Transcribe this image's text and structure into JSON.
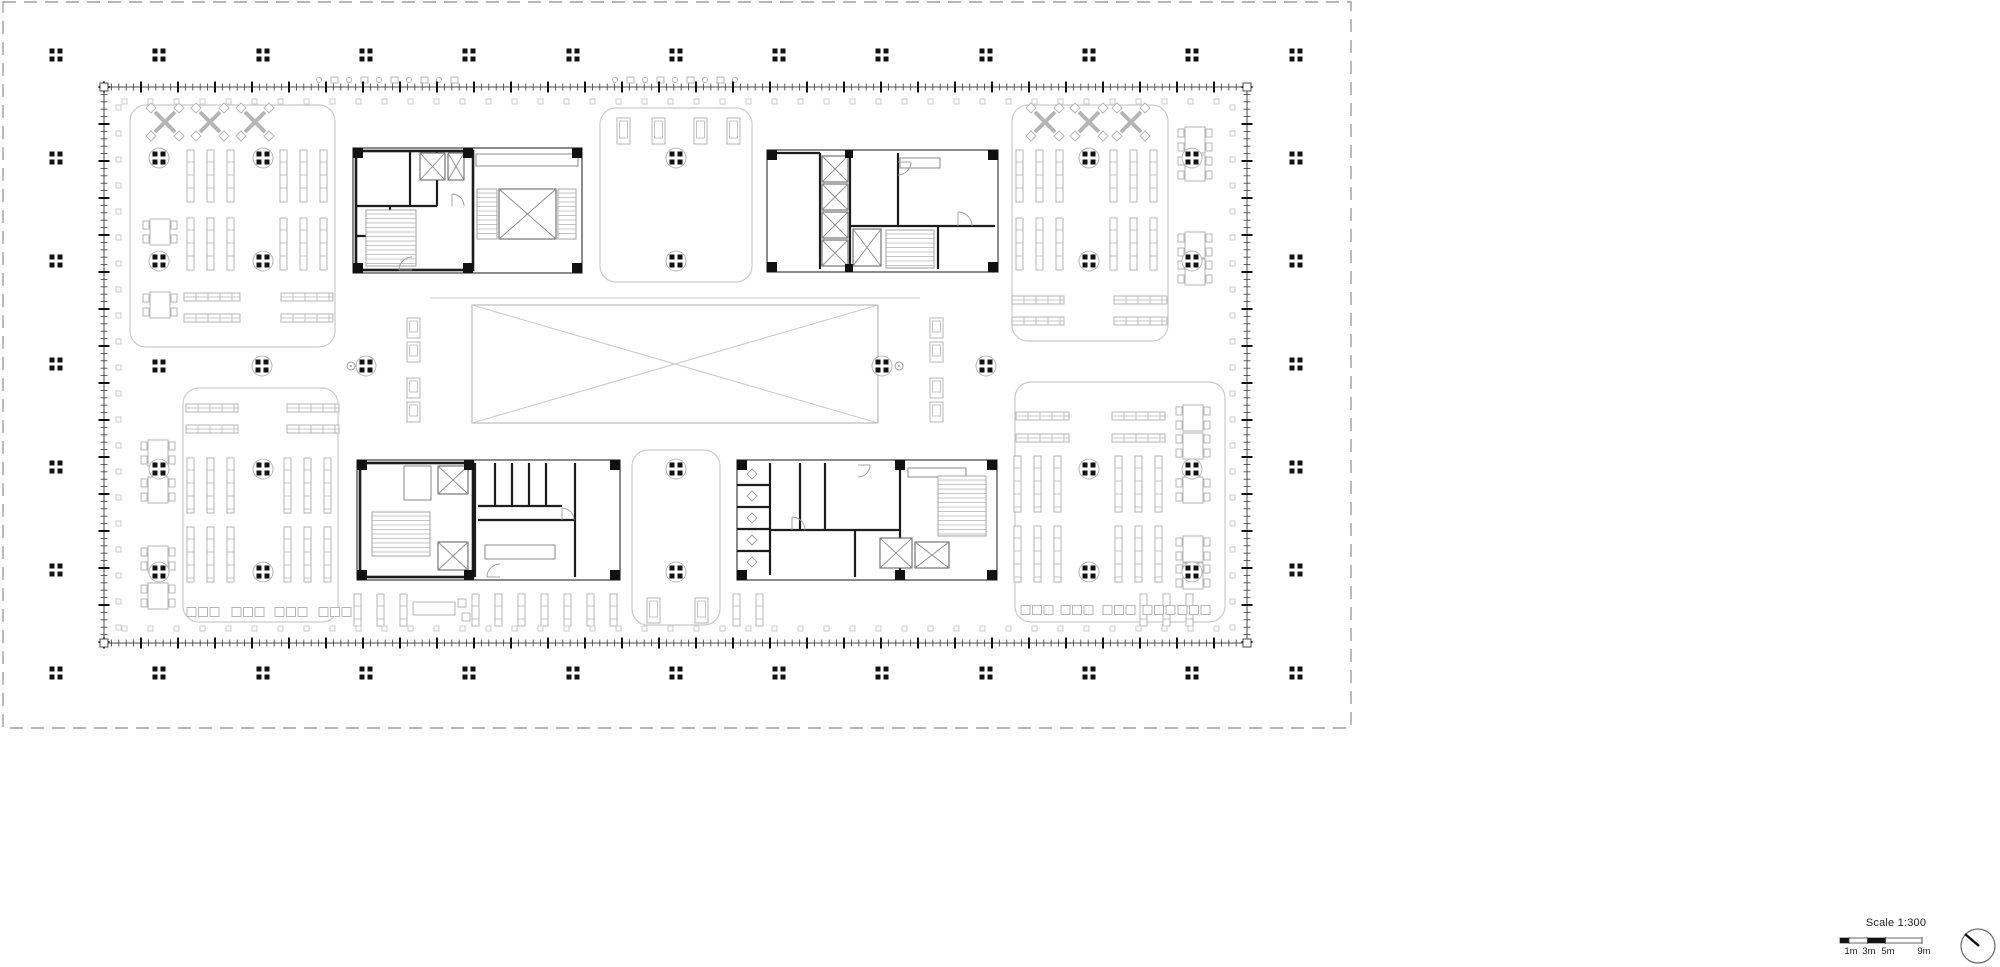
{
  "scale_indicator": {
    "label": "Scale 1:300",
    "tick_labels": [
      "1m",
      "3m",
      "5m",
      "9m"
    ],
    "bar": {
      "total_m": 9,
      "dark_segments_m": [
        [
          0,
          1
        ],
        [
          3,
          5
        ]
      ]
    }
  },
  "colors": {
    "black": "#121212",
    "wall": "#4a4a4a",
    "core": "#1c1c1c",
    "light": "#b5b5b5",
    "zone": "#cbcbcb",
    "boundary": "#9e9e9e",
    "door": "#9a9a9a"
  },
  "drawing": {
    "type": "library floor plan",
    "site_boundary": {
      "x": 3,
      "y": 2,
      "w": 1348,
      "h": 726
    },
    "building": {
      "x": 104,
      "y": 87,
      "w": 1143,
      "h": 556
    },
    "central_void": {
      "x": 472,
      "y": 305,
      "w": 406,
      "h": 118
    },
    "bridge_line": {
      "x1": 430,
      "y1": 298,
      "x2": 920,
      "y2": 298
    },
    "grid": {
      "cols_x": [
        56,
        159,
        263,
        366,
        469,
        573,
        676,
        779,
        882,
        986,
        1089,
        1192,
        1296
      ],
      "rows_y": [
        55,
        158,
        261,
        364,
        467,
        570,
        673
      ],
      "interior_circled": [
        [
          159,
          158
        ],
        [
          263,
          158
        ],
        [
          676,
          158
        ],
        [
          1089,
          158
        ],
        [
          1192,
          158
        ],
        [
          159,
          261
        ],
        [
          263,
          261
        ],
        [
          676,
          261
        ],
        [
          1089,
          261
        ],
        [
          1192,
          261
        ],
        [
          262,
          366
        ],
        [
          366,
          366
        ],
        [
          882,
          366
        ],
        [
          986,
          366
        ],
        [
          159,
          469
        ],
        [
          263,
          469
        ],
        [
          676,
          469
        ],
        [
          1089,
          469
        ],
        [
          1192,
          469
        ],
        [
          159,
          572
        ],
        [
          263,
          572
        ],
        [
          676,
          572
        ],
        [
          1089,
          572
        ],
        [
          1192,
          572
        ]
      ],
      "interior_plain": [
        [
          159,
          366
        ]
      ],
      "survey_marks": [
        [
          351,
          366
        ],
        [
          899,
          366
        ]
      ]
    },
    "zones": [
      {
        "name": "zone-reading-top-left",
        "x": 130,
        "y": 105,
        "w": 205,
        "h": 242
      },
      {
        "name": "zone-reading-top-right",
        "x": 1012,
        "y": 105,
        "w": 156,
        "h": 236
      },
      {
        "name": "zone-reading-bottom-left",
        "x": 183,
        "y": 388,
        "w": 155,
        "h": 234
      },
      {
        "name": "zone-reading-bottom-right",
        "x": 1015,
        "y": 382,
        "w": 210,
        "h": 240
      },
      {
        "name": "zone-lounge-top-middle",
        "x": 600,
        "y": 108,
        "w": 152,
        "h": 174
      },
      {
        "name": "zone-lounge-bottom-middle",
        "x": 632,
        "y": 450,
        "w": 88,
        "h": 175
      }
    ],
    "furniture": {
      "v_shelf_groups": [
        {
          "x": 187,
          "y": 150,
          "h": 52,
          "count": 3,
          "step": 20
        },
        {
          "x": 280,
          "y": 150,
          "h": 52,
          "count": 3,
          "step": 20
        },
        {
          "x": 187,
          "y": 218,
          "h": 52,
          "count": 3,
          "step": 20
        },
        {
          "x": 280,
          "y": 218,
          "h": 52,
          "count": 3,
          "step": 20
        },
        {
          "x": 1016,
          "y": 150,
          "h": 52,
          "count": 3,
          "step": 20
        },
        {
          "x": 1110,
          "y": 150,
          "h": 52,
          "count": 3,
          "step": 20
        },
        {
          "x": 1016,
          "y": 218,
          "h": 52,
          "count": 3,
          "step": 20
        },
        {
          "x": 1110,
          "y": 218,
          "h": 52,
          "count": 3,
          "step": 20
        },
        {
          "x": 187,
          "y": 458,
          "h": 55,
          "count": 3,
          "step": 20
        },
        {
          "x": 284,
          "y": 458,
          "h": 55,
          "count": 3,
          "step": 20
        },
        {
          "x": 187,
          "y": 527,
          "h": 55,
          "count": 3,
          "step": 20
        },
        {
          "x": 284,
          "y": 527,
          "h": 55,
          "count": 3,
          "step": 20
        },
        {
          "x": 1014,
          "y": 456,
          "h": 56,
          "count": 3,
          "step": 20
        },
        {
          "x": 1115,
          "y": 456,
          "h": 56,
          "count": 3,
          "step": 20
        },
        {
          "x": 1014,
          "y": 526,
          "h": 56,
          "count": 3,
          "step": 20
        },
        {
          "x": 1115,
          "y": 526,
          "h": 56,
          "count": 3,
          "step": 20
        },
        {
          "x": 354,
          "y": 594,
          "h": 32,
          "count": 3,
          "step": 23
        },
        {
          "x": 472,
          "y": 594,
          "h": 32,
          "count": 7,
          "step": 23
        },
        {
          "x": 733,
          "y": 594,
          "h": 32,
          "count": 2,
          "step": 23
        },
        {
          "x": 1140,
          "y": 594,
          "h": 32,
          "count": 3,
          "step": 23
        }
      ],
      "h_shelf_groups": [
        {
          "x": 184,
          "y": 293,
          "w": 56
        },
        {
          "x": 184,
          "y": 314,
          "w": 56
        },
        {
          "x": 281,
          "y": 293,
          "w": 52
        },
        {
          "x": 281,
          "y": 314,
          "w": 52
        },
        {
          "x": 1012,
          "y": 296,
          "w": 52
        },
        {
          "x": 1012,
          "y": 317,
          "w": 52
        },
        {
          "x": 1114,
          "y": 296,
          "w": 53
        },
        {
          "x": 1114,
          "y": 317,
          "w": 53
        },
        {
          "x": 186,
          "y": 404,
          "w": 52
        },
        {
          "x": 186,
          "y": 425,
          "w": 52
        },
        {
          "x": 287,
          "y": 404,
          "w": 52
        },
        {
          "x": 287,
          "y": 425,
          "w": 52
        },
        {
          "x": 1016,
          "y": 412,
          "w": 53
        },
        {
          "x": 1016,
          "y": 434,
          "w": 53
        },
        {
          "x": 1112,
          "y": 412,
          "w": 53
        },
        {
          "x": 1112,
          "y": 434,
          "w": 53
        }
      ],
      "x_tables": [
        [
          165,
          122
        ],
        [
          210,
          122
        ],
        [
          255,
          122
        ],
        [
          1045,
          122
        ],
        [
          1089,
          122
        ],
        [
          1131,
          122
        ]
      ],
      "square_tables": [
        [
          158,
          453
        ],
        [
          158,
          490
        ],
        [
          158,
          559
        ],
        [
          158,
          596
        ],
        [
          160,
          232
        ],
        [
          160,
          305
        ],
        [
          1195,
          140
        ],
        [
          1195,
          168
        ],
        [
          1195,
          245
        ],
        [
          1195,
          272
        ],
        [
          1193,
          418
        ],
        [
          1193,
          446
        ],
        [
          1193,
          490
        ],
        [
          1193,
          549
        ],
        [
          1193,
          576
        ]
      ],
      "seat_groups": [
        [
          202,
          612
        ],
        [
          247,
          612
        ],
        [
          290,
          612
        ],
        [
          334,
          612
        ],
        [
          1036,
          610
        ],
        [
          1076,
          610
        ],
        [
          1118,
          610
        ],
        [
          1158,
          610
        ],
        [
          1193,
          610
        ]
      ],
      "lounge_chairs": [
        [
          617,
          118,
          26
        ],
        [
          652,
          118,
          26
        ],
        [
          694,
          118,
          26
        ],
        [
          727,
          118,
          26
        ],
        [
          407,
          318,
          20
        ],
        [
          407,
          342,
          20
        ],
        [
          407,
          378,
          20
        ],
        [
          407,
          402,
          20
        ],
        [
          930,
          318,
          20
        ],
        [
          930,
          342,
          20
        ],
        [
          930,
          378,
          20
        ],
        [
          930,
          402,
          20
        ],
        [
          647,
          598,
          25
        ],
        [
          695,
          598,
          25
        ]
      ],
      "wall_items": [
        {
          "x": 316,
          "y": 77,
          "count": 10,
          "step": 15
        },
        {
          "x": 612,
          "y": 77,
          "count": 9,
          "step": 15
        }
      ],
      "desks": [
        [
          413,
          602
        ]
      ]
    },
    "cores": [
      {
        "name": "core-top-left",
        "outer": [
          353,
          148,
          229,
          125
        ],
        "heavy": [
          [
            356,
            151,
            117,
            119
          ]
        ],
        "walls": [
          [
            410,
            151,
            410,
            206
          ],
          [
            356,
            206,
            437,
            206
          ],
          [
            437,
            151,
            437,
            206
          ],
          [
            390,
            206,
            390,
            236
          ],
          [
            356,
            236,
            390,
            236
          ]
        ],
        "blacks": [
          [
            353,
            148,
            10,
            10
          ],
          [
            463,
            148,
            10,
            10
          ],
          [
            353,
            263,
            10,
            10
          ],
          [
            463,
            263,
            10,
            10
          ],
          [
            572,
            148,
            10,
            10
          ],
          [
            572,
            263,
            10,
            10
          ]
        ],
        "xboxes": [
          [
            420,
            153,
            25,
            27
          ],
          [
            448,
            153,
            16,
            27
          ],
          [
            499,
            189,
            57,
            50
          ]
        ],
        "stairs": [
          [
            366,
            210,
            50,
            56
          ],
          [
            477,
            189,
            20,
            50
          ],
          [
            558,
            189,
            18,
            50
          ]
        ],
        "rects": [
          [
            476,
            154,
            102,
            12
          ]
        ],
        "arcs": [
          [
            412,
            270,
            13,
            2
          ],
          [
            452,
            206,
            12,
            3
          ]
        ]
      },
      {
        "name": "core-top-right",
        "outer": [
          767,
          150,
          231,
          122
        ],
        "heavy": [],
        "walls": [
          [
            820,
            153,
            820,
            269
          ],
          [
            850,
            153,
            850,
            269
          ],
          [
            850,
            226,
            995,
            226
          ],
          [
            898,
            153,
            898,
            226
          ],
          [
            938,
            226,
            938,
            269
          ],
          [
            770,
            153,
            820,
            153
          ]
        ],
        "blacks": [
          [
            767,
            150,
            10,
            10
          ],
          [
            988,
            150,
            10,
            10
          ],
          [
            767,
            262,
            10,
            10
          ],
          [
            988,
            262,
            10,
            10
          ],
          [
            845,
            150,
            8,
            8
          ],
          [
            845,
            264,
            8,
            8
          ]
        ],
        "xboxes": [
          [
            822,
            156,
            26,
            26
          ],
          [
            822,
            184,
            26,
            26
          ],
          [
            822,
            212,
            26,
            26
          ],
          [
            822,
            240,
            26,
            26
          ],
          [
            853,
            229,
            28,
            37
          ]
        ],
        "stairs": [
          [
            886,
            230,
            48,
            38
          ]
        ],
        "rects": [
          [
            900,
            158,
            40,
            10
          ]
        ],
        "arcs": [
          [
            898,
            162,
            13,
            0
          ],
          [
            958,
            226,
            14,
            3
          ]
        ]
      },
      {
        "name": "core-bottom-left",
        "outer": [
          357,
          460,
          263,
          120
        ],
        "heavy": [
          [
            360,
            463,
            113,
            114
          ]
        ],
        "walls": [
          [
            475,
            463,
            475,
            577
          ],
          [
            478,
            520,
            575,
            520
          ],
          [
            575,
            463,
            575,
            577
          ],
          [
            495,
            463,
            495,
            506
          ],
          [
            512,
            463,
            512,
            506
          ],
          [
            529,
            463,
            529,
            506
          ],
          [
            546,
            463,
            546,
            506
          ],
          [
            478,
            506,
            562,
            506
          ]
        ],
        "blacks": [
          [
            357,
            460,
            10,
            10
          ],
          [
            357,
            570,
            10,
            10
          ],
          [
            464,
            460,
            10,
            10
          ],
          [
            464,
            570,
            10,
            10
          ],
          [
            610,
            460,
            10,
            10
          ],
          [
            610,
            570,
            10,
            10
          ]
        ],
        "xboxes": [
          [
            438,
            466,
            30,
            28
          ],
          [
            438,
            542,
            30,
            28
          ]
        ],
        "stairs": [
          [
            372,
            512,
            58,
            44
          ]
        ],
        "rects": [
          [
            404,
            466,
            27,
            34
          ],
          [
            485,
            545,
            70,
            14
          ]
        ],
        "arcs": [
          [
            500,
            577,
            13,
            2
          ],
          [
            562,
            520,
            12,
            3
          ]
        ]
      },
      {
        "name": "core-bottom-right",
        "outer": [
          737,
          460,
          260,
          120
        ],
        "heavy": [],
        "walls": [
          [
            770,
            463,
            770,
            575
          ],
          [
            737,
            485,
            770,
            485
          ],
          [
            737,
            507,
            770,
            507
          ],
          [
            737,
            529,
            770,
            529
          ],
          [
            737,
            551,
            770,
            551
          ],
          [
            825,
            463,
            825,
            530
          ],
          [
            770,
            530,
            900,
            530
          ],
          [
            900,
            463,
            900,
            577
          ],
          [
            855,
            530,
            855,
            577
          ],
          [
            800,
            463,
            800,
            530
          ]
        ],
        "blacks": [
          [
            737,
            460,
            10,
            10
          ],
          [
            987,
            460,
            10,
            10
          ],
          [
            737,
            570,
            10,
            10
          ],
          [
            987,
            570,
            10,
            10
          ],
          [
            895,
            460,
            10,
            10
          ],
          [
            895,
            570,
            10,
            10
          ]
        ],
        "xboxes": [
          [
            880,
            538,
            32,
            30
          ],
          [
            915,
            542,
            34,
            26
          ]
        ],
        "stairs": [
          [
            938,
            476,
            48,
            60
          ]
        ],
        "rects": [
          [
            908,
            468,
            58,
            9
          ]
        ],
        "diamonds": [
          [
            752,
            474
          ],
          [
            752,
            496
          ],
          [
            752,
            518
          ],
          [
            752,
            540
          ],
          [
            752,
            562
          ]
        ],
        "arcs": [
          [
            792,
            530,
            13,
            3
          ],
          [
            858,
            465,
            12,
            0
          ]
        ]
      }
    ]
  }
}
